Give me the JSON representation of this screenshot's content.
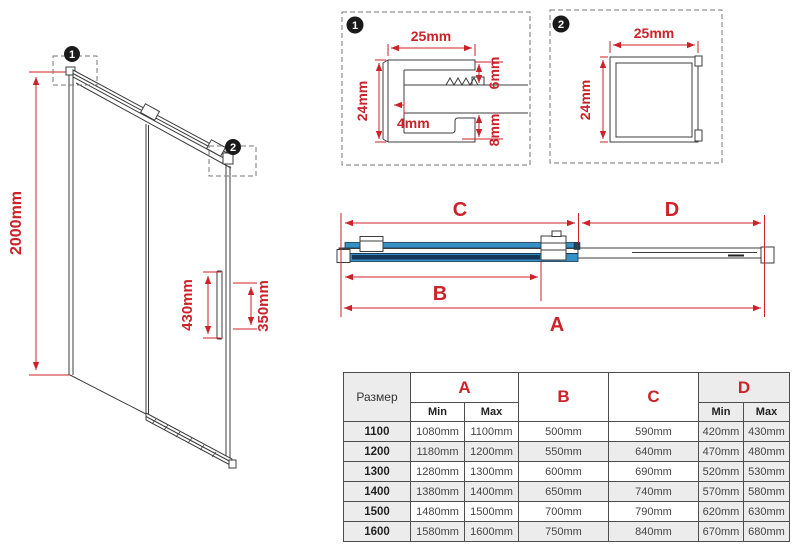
{
  "left_diagram": {
    "callout1": "1",
    "callout2": "2",
    "height": "2000mm",
    "handle_height": "430mm",
    "handle_inner": "350mm"
  },
  "detail1": {
    "callout": "1",
    "width": "25mm",
    "height": "24mm",
    "glass": "4mm",
    "top_gap": "6mm",
    "bottom_gap": "8mm"
  },
  "detail2": {
    "callout": "2",
    "width": "25mm",
    "height": "24mm"
  },
  "plan": {
    "a": "A",
    "b": "B",
    "c": "C",
    "d": "D"
  },
  "table": {
    "size_header": "Размер",
    "a": "A",
    "b": "B",
    "c": "C",
    "d": "D",
    "min": "Min",
    "max": "Max",
    "rows": [
      {
        "size": "1100",
        "a_min": "1080mm",
        "a_max": "1100mm",
        "b": "500mm",
        "c": "590mm",
        "d_min": "420mm",
        "d_max": "430mm"
      },
      {
        "size": "1200",
        "a_min": "1180mm",
        "a_max": "1200mm",
        "b": "550mm",
        "c": "640mm",
        "d_min": "470mm",
        "d_max": "480mm"
      },
      {
        "size": "1300",
        "a_min": "1280mm",
        "a_max": "1300mm",
        "b": "600mm",
        "c": "690mm",
        "d_min": "520mm",
        "d_max": "530mm"
      },
      {
        "size": "1400",
        "a_min": "1380mm",
        "a_max": "1400mm",
        "b": "650mm",
        "c": "740mm",
        "d_min": "570mm",
        "d_max": "580mm"
      },
      {
        "size": "1500",
        "a_min": "1480mm",
        "a_max": "1500mm",
        "b": "700mm",
        "c": "790mm",
        "d_min": "620mm",
        "d_max": "630mm"
      },
      {
        "size": "1600",
        "a_min": "1580mm",
        "a_max": "1600mm",
        "b": "750mm",
        "c": "840mm",
        "d_min": "670mm",
        "d_max": "680mm"
      }
    ]
  },
  "colors": {
    "red": "#cc2229",
    "blue": "#3590c5",
    "navy": "#14375a",
    "gray": "#ececec"
  }
}
